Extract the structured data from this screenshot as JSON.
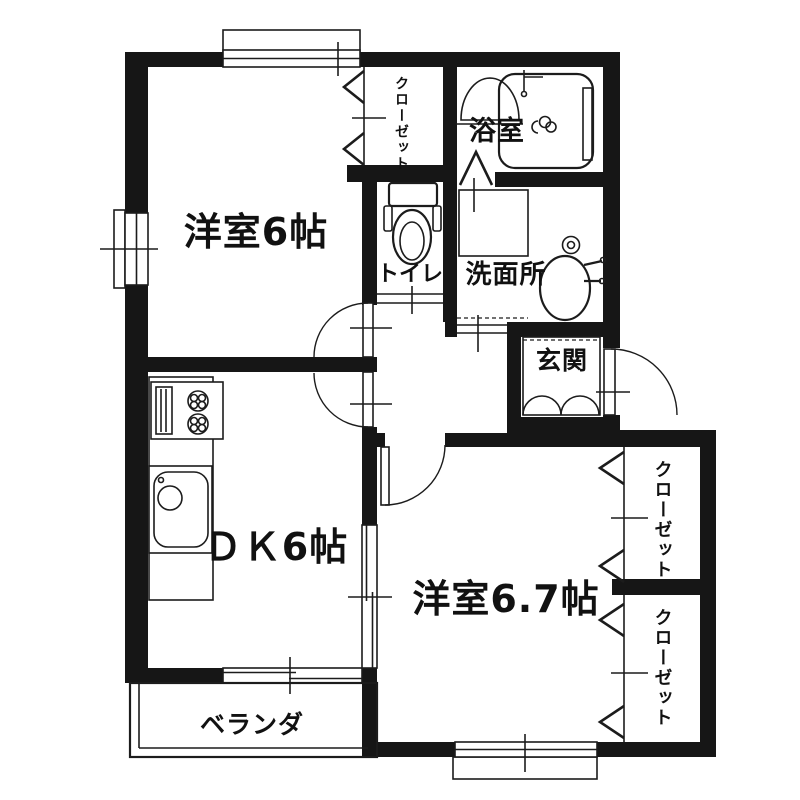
{
  "plan": {
    "type": "floor-plan",
    "colors": {
      "wall": "#161616",
      "line": "#1c1c1c",
      "background": "#ffffff"
    },
    "rooms": {
      "west_room": {
        "label": "洋室6帖"
      },
      "closet_top": {
        "label": "クローゼット"
      },
      "bath": {
        "label": "浴室"
      },
      "toilet": {
        "label": "トイレ"
      },
      "washroom": {
        "label": "洗面所"
      },
      "entrance": {
        "label": "玄関"
      },
      "dk": {
        "label": "ＤＫ6帖"
      },
      "bedroom": {
        "label": "洋室6.7帖"
      },
      "closet_a": {
        "label": "クローゼット"
      },
      "closet_b": {
        "label": "クローゼット"
      },
      "veranda": {
        "label": "ベランダ"
      }
    }
  }
}
